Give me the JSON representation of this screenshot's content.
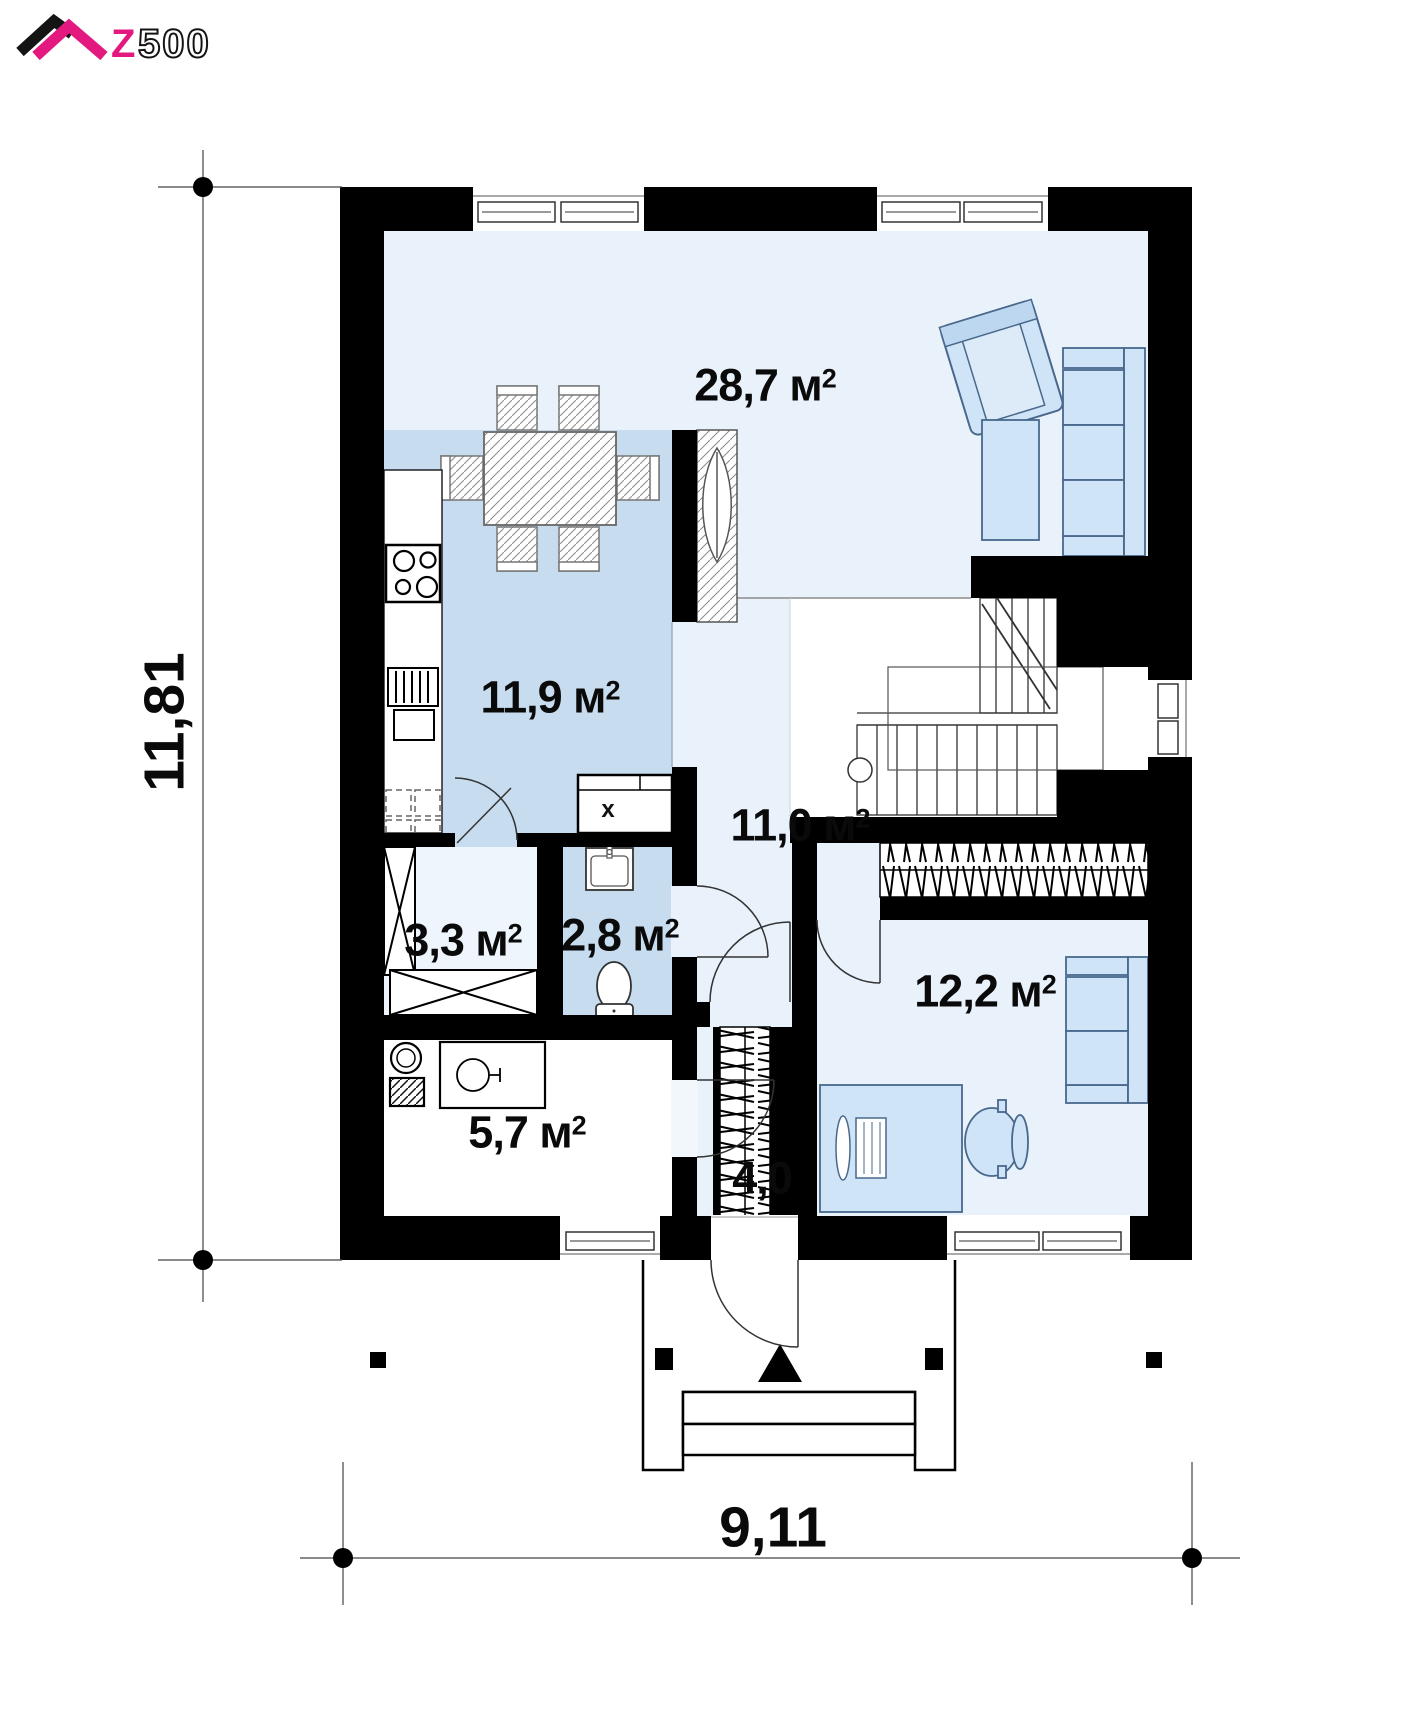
{
  "logo": {
    "z": "Z",
    "numbers": "500"
  },
  "plan": {
    "dimensions": {
      "width_m": "9,11",
      "height_m": "11,81"
    },
    "area_unit": {
      "letter": "м",
      "exponent": "2"
    },
    "rooms": [
      {
        "key": "living-dining",
        "area": "28,7"
      },
      {
        "key": "kitchen",
        "area": "11,9"
      },
      {
        "key": "hall",
        "area": "11,0"
      },
      {
        "key": "pantry",
        "area": "3,3"
      },
      {
        "key": "bathroom",
        "area": "2,8"
      },
      {
        "key": "utility",
        "area": "5,7"
      },
      {
        "key": "vestibule",
        "area": "4,0"
      },
      {
        "key": "bedroom-office",
        "area": "12,2"
      }
    ],
    "markers": {
      "kitchen_sink": "x"
    }
  },
  "colors": {
    "brand_pink": "#e3197f",
    "wall": "#000000",
    "floor_light": "#e9f2fb",
    "floor_medium": "#c8dcf0",
    "furniture_blue": "#cfe4f7"
  }
}
